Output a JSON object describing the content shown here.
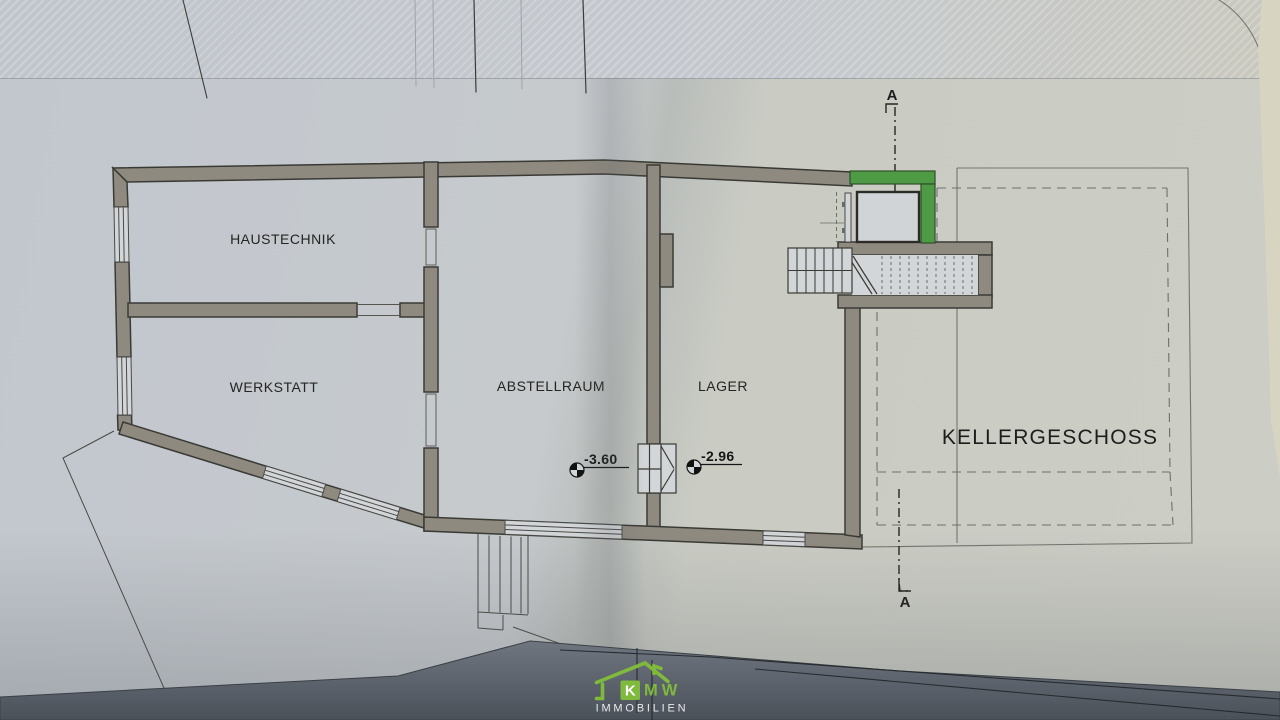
{
  "plan": {
    "floor_label": "KELLERGESCHOSS",
    "rooms": [
      {
        "name": "HAUSTECHNIK",
        "color": "#8e4236"
      },
      {
        "name": "WERKSTATT",
        "color": "#242421"
      },
      {
        "name": "ABSTELLRAUM",
        "color": "#242421"
      },
      {
        "name": "LAGER",
        "color": "#242421"
      }
    ],
    "level_markers": [
      {
        "value": "-3.60"
      },
      {
        "value": "-2.96"
      }
    ],
    "section_line": {
      "top_label": "A",
      "bottom_label": "A"
    }
  },
  "watermark": {
    "monogram_k": "K",
    "monogram_mw": "MW",
    "subtitle": "IMMOBILIEN",
    "green": "#7fba3d"
  },
  "colors": {
    "wall_fill": "#8f8a80",
    "elevator_shaft_green": "#4f9b45",
    "haustechnik_label_red": "#8e4236",
    "paper": "#c6cacc",
    "paper_edge_cream": "#d8d4c2",
    "bottom_band_dark": "#4c525a"
  }
}
